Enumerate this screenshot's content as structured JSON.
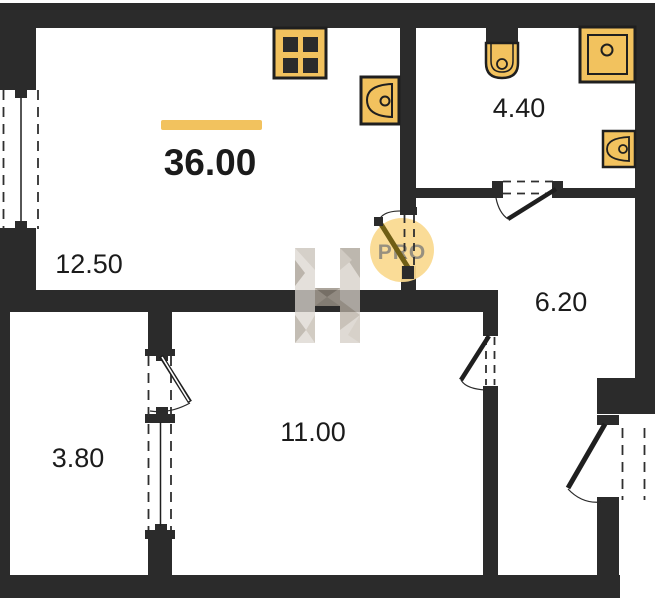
{
  "plan": {
    "total_area": "36.00",
    "watermark_brand": "PRO",
    "rooms": [
      {
        "id": "living-kitchen",
        "area": "12.50"
      },
      {
        "id": "bathroom",
        "area": "4.40"
      },
      {
        "id": "hallway",
        "area": "6.20"
      },
      {
        "id": "room",
        "area": "11.00"
      },
      {
        "id": "balcony",
        "area": "3.80"
      }
    ]
  },
  "colors": {
    "wall": "#2b2b2b",
    "accent": "#F2C25E",
    "accent_light": "#FAD98E",
    "watermark_text": "#97907F",
    "text": "#1B1B1B"
  }
}
